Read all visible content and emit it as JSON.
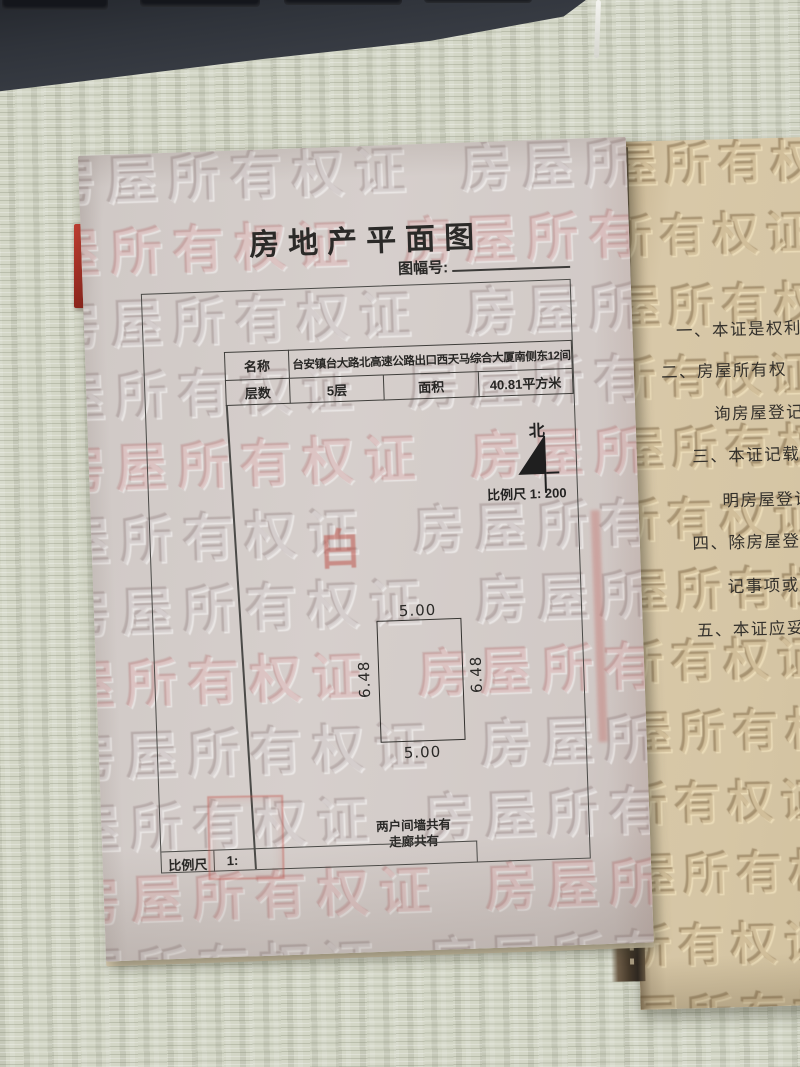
{
  "title": "房地产平面图",
  "map_sheet": {
    "label": "图幅号:"
  },
  "info_table": {
    "name_label": "名称",
    "name_value": "台安镇台大路北高速公路出口西天马综合大厦南侧东12间",
    "floors_label": "层数",
    "floors_value": "5层",
    "area_label": "面积",
    "area_value": "40.81平方米"
  },
  "compass": {
    "north_label": "北",
    "scale_text": "比例尺 1: 200"
  },
  "floor_plan": {
    "top_dim": "5.00",
    "bottom_dim": "5.00",
    "left_dim": "6.48",
    "right_dim": "6.48",
    "note_line1": "两户间墙共有",
    "note_line2": "走廊共有"
  },
  "stamps": {
    "red_character": "白"
  },
  "scale_footer": {
    "label": "比例尺",
    "value": "1:"
  },
  "watermark": {
    "text": "房屋所有权证",
    "row": "房屋所有权证 房屋所有权证 房屋所有权证 房屋所有权证"
  },
  "right_page": {
    "lines": [
      "一、本证是权利",
      "二、房屋所有权",
      "询房屋登记",
      "三、本证记载的",
      "明房屋登记",
      "四、除房屋登记",
      "记事项或",
      "五、本证应妥"
    ]
  },
  "colors": {
    "left_paper": "#d2cbc8",
    "right_paper": "#d5c5a3",
    "desk": "#d3d6c6",
    "keyboard": "#30343b",
    "stamp_red": "#bb4a40",
    "ink": "#2f2d2a",
    "border_line": "#4a4a47"
  }
}
